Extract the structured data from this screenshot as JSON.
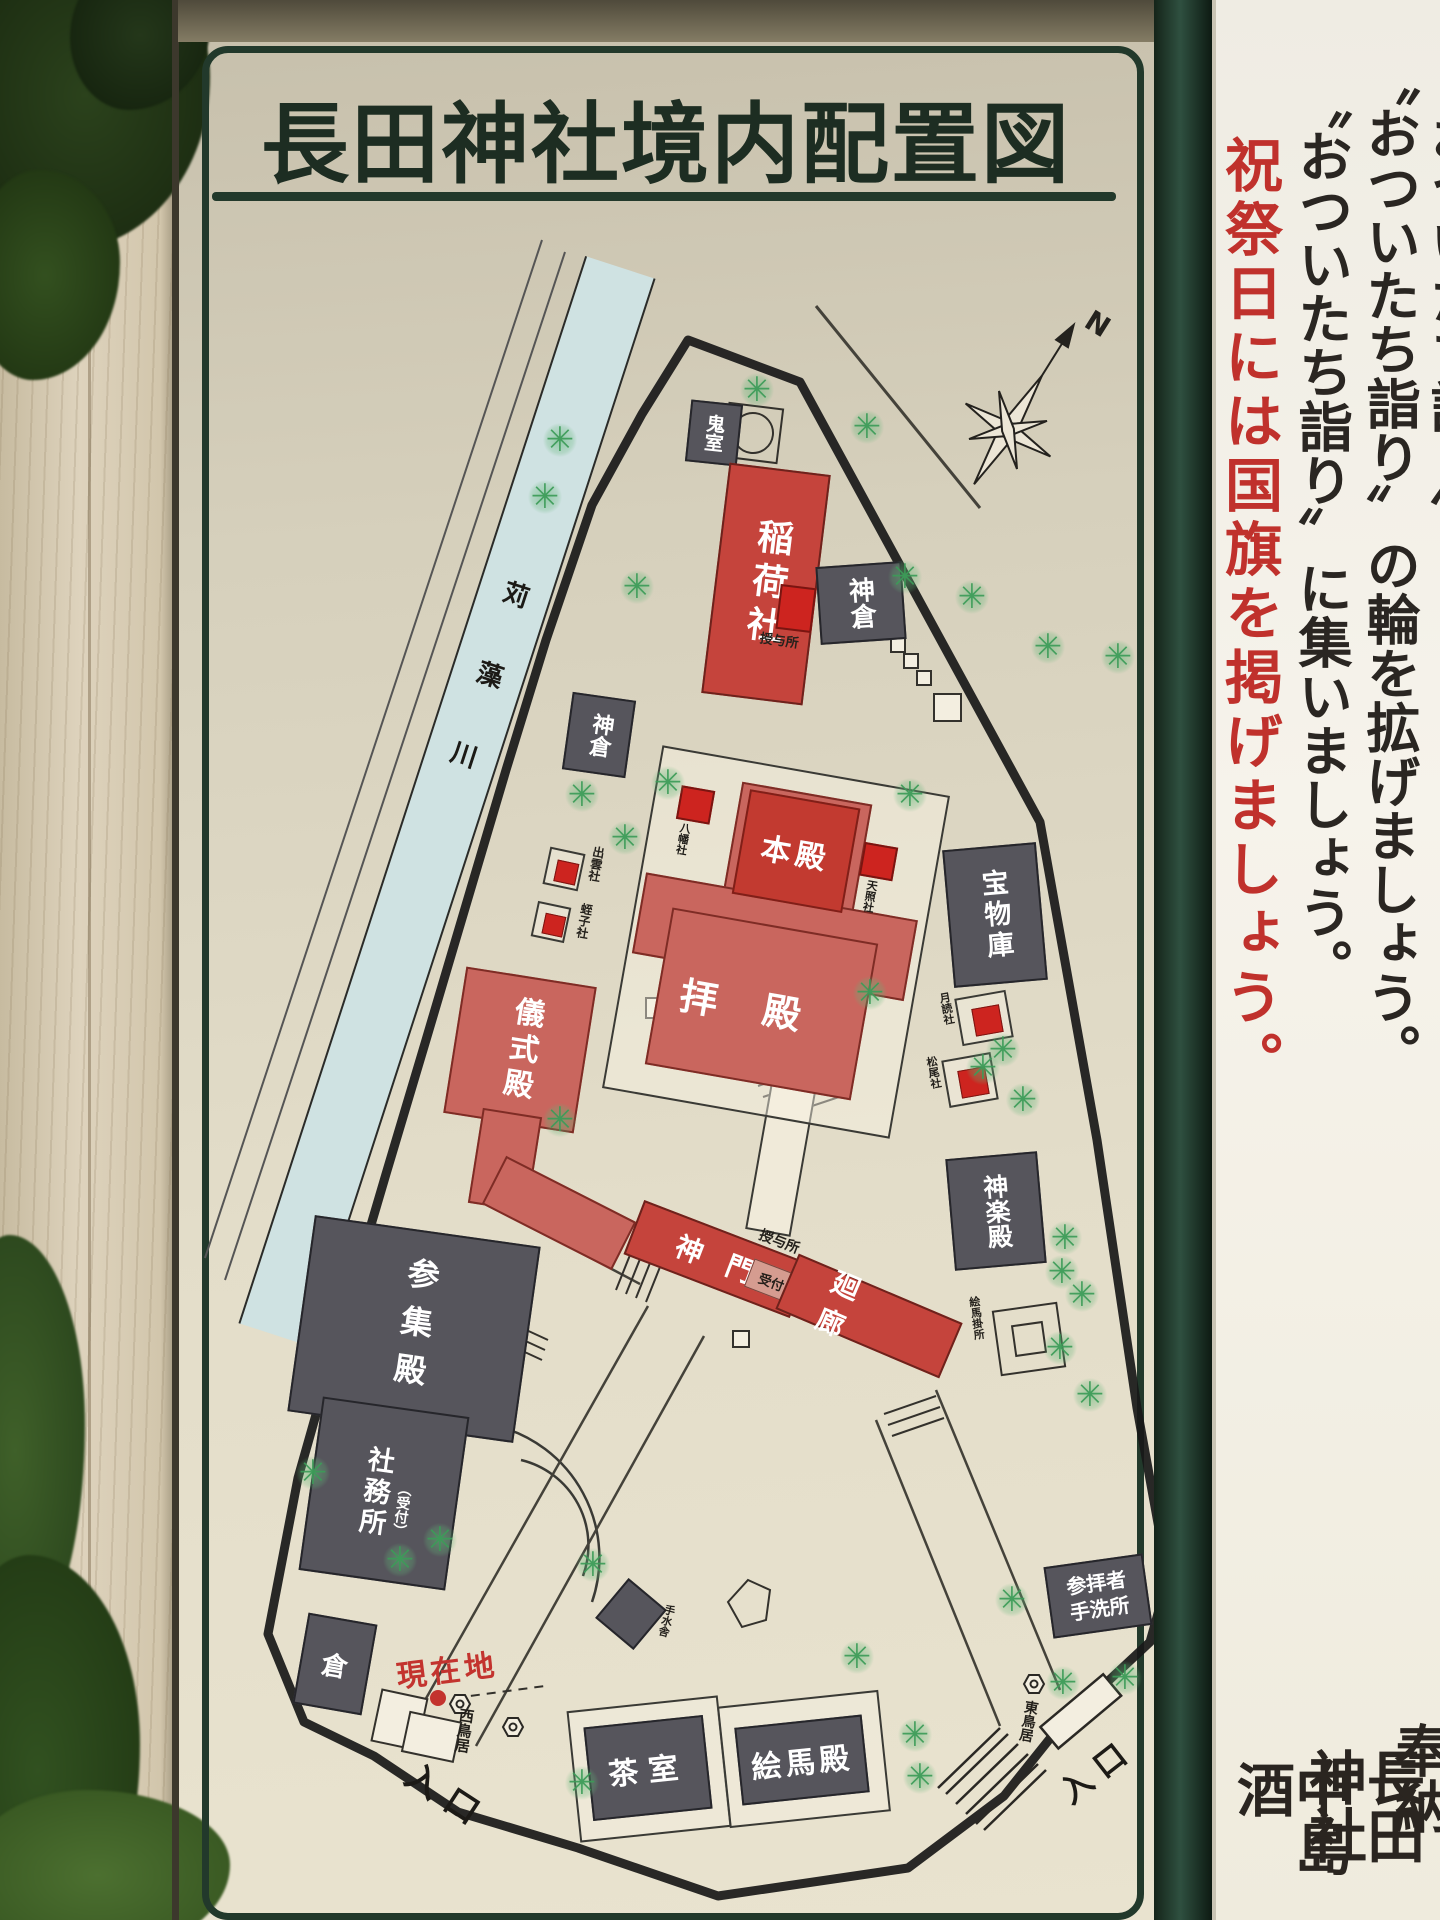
{
  "sign": {
    "title": "長田神社境内配置図",
    "compass_north": "N",
    "river_name": "苅藻川",
    "map_labels": {
      "kishitsu": "鬼室",
      "inari_sha": "稲荷社",
      "kamikura_east": "神倉",
      "kamikura_west": "神倉",
      "juyosho_north": "授与所",
      "honden": "本殿",
      "haiden": "拝殿",
      "hachiman_sha": "八幡社",
      "tensho_sha": "天照社",
      "izumo_sha": "出雲社",
      "hiruko_sha": "蛭子社",
      "homotsuko": "宝物庫",
      "tsukiyomi_sha": "月読社",
      "matsuo_sha": "松尾社",
      "gishikiden": "儀式殿",
      "sanshuden": "参集殿",
      "shamusho": "社務所",
      "shamusho_note": "（受付）",
      "shinmon": "神門",
      "uketsuke": "受付",
      "juyosho_south": "授与所",
      "kairo": "廻廊",
      "kaguraden": "神楽殿",
      "emakakesho": "絵馬掛所",
      "kura": "倉",
      "genzaichi": "現在地",
      "nishi_torii": "西鳥居",
      "iriguchi_west": "入口",
      "temizusha": "手水舎",
      "chashitsu": "茶室",
      "emaden": "絵馬殿",
      "sanpaisha_tearaisho": "参拝者手洗所",
      "higashi_torii": "東鳥居",
      "iriguchi_east": "入口"
    }
  },
  "side_panel": {
    "accent_color": "#c0312c",
    "notice_columns": [
      {
        "text": "〝おついたち詣り〟"
      },
      {
        "text": "〝おついたち詣り〟の輪を拡げましょう。"
      },
      {
        "text": "〝おついたち詣り〟に集いましょう。"
      },
      {
        "text": "祝祭日には国旗を掲げましょう。"
      }
    ],
    "dedication_columns": [
      "奉納",
      "長田神社",
      "中島酒"
    ]
  }
}
